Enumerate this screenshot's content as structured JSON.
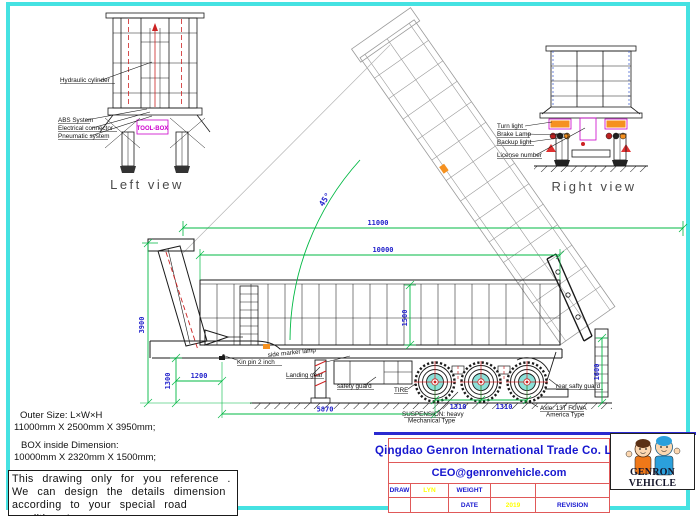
{
  "left_view": {
    "caption": "Left view",
    "labels": {
      "hydraulic_cylinder": "Hydraulic cylinder",
      "abs_system": "ABS System",
      "electrical_connector": "Electrical connector",
      "pneumatic_system": "Pneumatic system",
      "tool_box": "TOOL-BOX"
    }
  },
  "right_view": {
    "caption": "Right view",
    "labels": {
      "turn_light": "Turn light",
      "brake_lamp": "Brake Lamp",
      "backup_light": "Backup light",
      "license_number": "License number"
    }
  },
  "main_view": {
    "dimensions": {
      "overall_length": "11000",
      "box_length": "10000",
      "box_inner_height": "1500",
      "rear_height": "1600",
      "overall_height": "3900",
      "chassis_height": "1300",
      "kingpin_offset": "1200",
      "kingpin_to_axle": "5870",
      "axle_spacing_front": "1310",
      "axle_spacing_rear": "1310",
      "tipping_angle": "45°"
    },
    "labels": {
      "king_pin": "Kin pin 2 inch",
      "side_marker": "side marker lamp",
      "landing_gear": "Landing gear",
      "safety_guard": "safety guard",
      "tire": "TIRE",
      "suspension_line1": "SUSPENSION: heavy",
      "suspension_line2": "Mechanical Type",
      "rear_safety_guard": "rear safty guard",
      "axle_line1": "Axle: 13T FUWA",
      "axle_line2": "America Type"
    }
  },
  "notes": {
    "outer_size_label": "Outer Size: L×W×H",
    "outer_size_value": "11000mm X 2500mm X 3950mm;",
    "box_size_label": "BOX inside Dimension:",
    "box_size_value": "10000mm X 2320mm X 1500mm;",
    "disclaimer": {
      "line1": "This drawing only for you reference .",
      "line2": "We can design the details dimension",
      "line3": "according to your special road condition !"
    }
  },
  "title_block": {
    "company": "Qingdao Genron International Trade Co. Ltd",
    "email": "CEO@genronvehicle.com",
    "fields": {
      "draw_label": "DRAW",
      "draw_value": "LYN",
      "weight_label": "WEIGHT",
      "date_label": "DATE",
      "date_value": "2019",
      "revision_label": "REVISION"
    },
    "logo_text": "GENRON VEHICLE"
  },
  "colors": {
    "frame_cyan": "#45e2e2",
    "dimension_green": "#00b843",
    "dimension_blue": "#2323cc",
    "accent_red": "#cc2222",
    "table_red": "#e05959",
    "company_blue": "#1717cf",
    "value_yellow": "#ffff00",
    "toolbox_magenta": "#cc00cc",
    "hub_cyan": "#8ce0d8",
    "lamp_orange": "#f59120"
  }
}
